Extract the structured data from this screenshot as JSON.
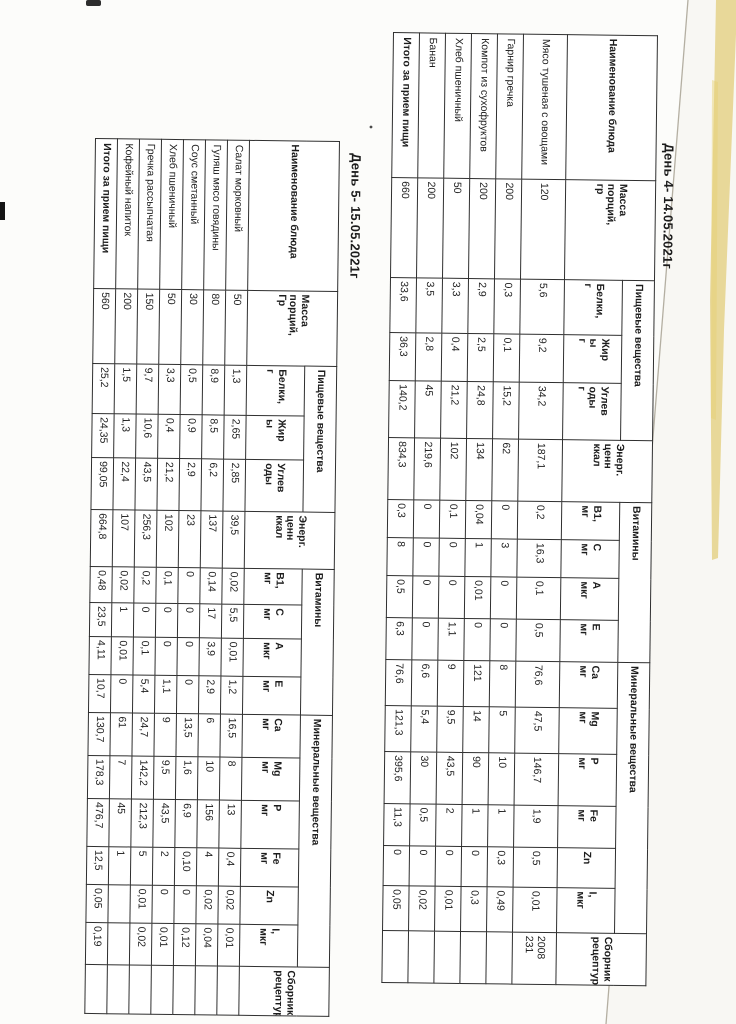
{
  "colors": {
    "paper": "#fcfcfa",
    "table_border": "#2f2f2f",
    "text": "#1c1c1c",
    "page_edge_line": "#b4afa2",
    "edge_yellow": "#ddc35e"
  },
  "tables": {
    "day4": {
      "title": "День 4- 14.05.2021г",
      "headers": {
        "name": "Наименование блюда",
        "mass": "Масса\nпорций,\nгр",
        "nutrients": {
          "label": "Пищевые вещества",
          "subs": [
            "Белки,\nг",
            "Жир\nы\nг",
            "Углев\nоды\nг"
          ]
        },
        "energy": "Энерг.\nценн\nккал",
        "vitamins": {
          "label": "Витамины",
          "subs": [
            "B1,\nмг",
            "C\nмг",
            "A\nмкг",
            "E\nмг"
          ]
        },
        "minerals": {
          "label": "Минеральные вещества",
          "subs": [
            "Ca\nмг",
            "Mg\nмг",
            "P\nмг",
            "Fe\nмг",
            "Zn",
            "I,\nмкг"
          ]
        },
        "recipe": "Сборник\nрецептур"
      },
      "rows": [
        [
          "Мясо  тушеная с овощами",
          "120",
          "5,6",
          "9,2",
          "34,2",
          "187,1",
          "0,2",
          "16,3",
          "0,1",
          "0,5",
          "76,6",
          "47,5",
          "146,7",
          "1,9",
          "0,5",
          "0,01",
          "2008 231"
        ],
        [
          "Гарнир гречка",
          "200",
          "0,3",
          "0,1",
          "15,2",
          "62",
          "0",
          "3",
          "0",
          "0",
          "8",
          "5",
          "10",
          "1",
          "0,3",
          "0,49",
          ""
        ],
        [
          "Компот из сухофруктов",
          "200",
          "2,9",
          "2,5",
          "24,8",
          "134",
          "0,04",
          "1",
          "0,01",
          "0",
          "121",
          "14",
          "90",
          "1",
          "0",
          "0,3",
          ""
        ],
        [
          "Хлеб пшеничный",
          "50",
          "3,3",
          "0,4",
          "21,2",
          "102",
          "0,1",
          "0",
          "0",
          "1,1",
          "9",
          "9,5",
          "43,5",
          "2",
          "0",
          "0,01",
          ""
        ],
        [
          "Банан",
          "200",
          "3,5",
          "2,8",
          "45",
          "219,6",
          "0",
          "0",
          "0",
          "0",
          "6,6",
          "5,4",
          "30",
          "0,5",
          "0",
          "0,02",
          ""
        ]
      ],
      "total_row": [
        "Итого за прием пищи",
        "660",
        "33,6",
        "36,3",
        "140,2",
        "834,3",
        "0,3",
        "8",
        "0,5",
        "6,3",
        "76,6",
        "121,3",
        "395,6",
        "11,3",
        "0",
        "0,05",
        ""
      ]
    },
    "day5": {
      "title": "День 5- 15.05.2021г",
      "headers": {
        "name": "Наименование блюда",
        "mass": "Масса\nпорций,\nГр",
        "nutrients": {
          "label": "Пищевые вещества",
          "subs": [
            "Белки,\nг",
            "Жир\nы",
            "Углев\nоды"
          ]
        },
        "energy": "Энерг.\nценн\nккал",
        "vitamins": {
          "label": "Витамины",
          "subs": [
            "B1,\nмг",
            "C\nмг",
            "A\nмкг",
            "E\nмг"
          ]
        },
        "minerals": {
          "label": "Минеральные вещества",
          "subs": [
            "Ca\nмг",
            "Mg\nмг",
            "P\nмг",
            "Fe\nмг",
            "Zn",
            "I,\nмкг"
          ]
        },
        "recipe": "Сборник\nрецептур"
      },
      "rows": [
        [
          "Салат морковный",
          "50",
          "1,3",
          "2,65",
          "2,85",
          "39,5",
          "0,02",
          "5,5",
          "0,01",
          "1,2",
          "16,5",
          "8",
          "13",
          "0,4",
          "0,02",
          "0,01",
          ""
        ],
        [
          "Гуляш  мясо говядины",
          "80",
          "8,9",
          "8,5",
          "6,2",
          "137",
          "0,14",
          "17",
          "3,9",
          "2,9",
          "6",
          "10",
          "156",
          "4",
          "0,02",
          "0,04",
          ""
        ],
        [
          "Соус сметанный",
          "30",
          "0,5",
          "0,9",
          "2,9",
          "23",
          "0",
          "0",
          "0",
          "0",
          "13,5",
          "1,6",
          "6,9",
          "0,10",
          "0",
          "0,12",
          ""
        ],
        [
          "Хлеб пшеничный",
          "50",
          "3,3",
          "0,4",
          "21,2",
          "102",
          "0,1",
          "0",
          "0",
          "1,1",
          "9",
          "9,5",
          "43,5",
          "2",
          "0",
          "0,01",
          ""
        ],
        [
          "Гречка рассыпчатая",
          "150",
          "9,7",
          "10,6",
          "43,5",
          "256,3",
          "0,2",
          "0",
          "0,1",
          "5,4",
          "24,7",
          "142,2",
          "212,3",
          "5",
          "0,01",
          "0,02",
          ""
        ],
        [
          "Кофейный напиток",
          "200",
          "1,5",
          "1,3",
          "22,4",
          "107",
          "0,02",
          "1",
          "0,01",
          "0",
          "61",
          "7",
          "45",
          "1",
          "",
          "",
          ""
        ]
      ],
      "total_row": [
        "Итого за прием пищи",
        "560",
        "25,2",
        "24,35",
        "99,05",
        "664,8",
        "0,48",
        "23,5",
        "4,11",
        "10,7",
        "130,7",
        "178,3",
        "476,7",
        "12,5",
        "0,05",
        "0,19",
        ""
      ]
    }
  }
}
